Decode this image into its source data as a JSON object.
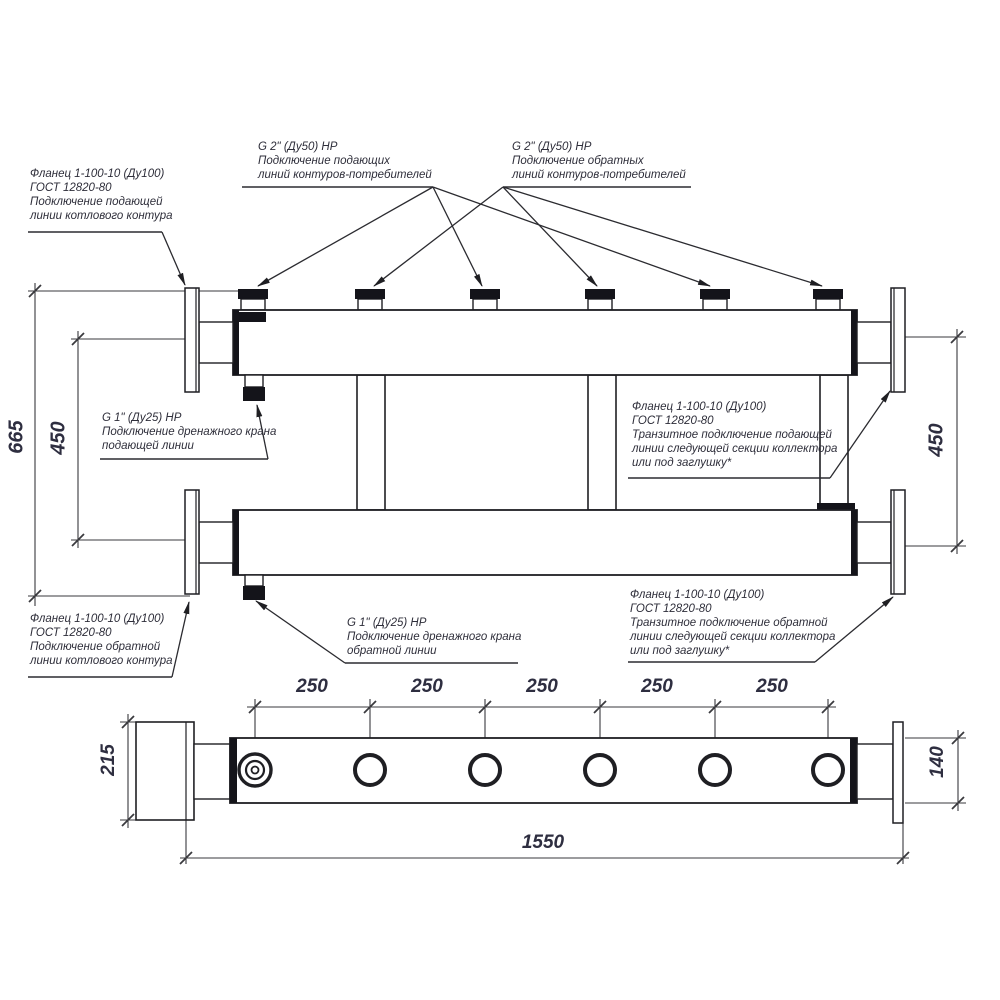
{
  "labels": {
    "flange_supply_boiler": "Фланец 1-100-10 (Ду100)\nГОСТ 12820-80\nПодключение подающей\nлинии котлового контура",
    "supply_consumers": "G 2\" (Ду50) НР\nПодключение подающих\nлиний контуров-потребителей",
    "return_consumers": "G 2\" (Ду50) НР\nПодключение обратных\nлиний контуров-потребителей",
    "drain_supply": "G 1\" (Ду25) НР\nПодключение дренажного крана\nподающей линии",
    "flange_transit_supply": "Фланец 1-100-10 (Ду100)\nГОСТ 12820-80\nТранзитное подключение подающей\nлинии следующей секции коллектора\nили под заглушку*",
    "flange_return_boiler": "Фланец 1-100-10 (Ду100)\nГОСТ 12820-80\nПодключение обратной\nлинии котлового контура",
    "drain_return": "G 1\" (Ду25) НР\nПодключение дренажного крана\nобратной линии",
    "flange_transit_return": "Фланец 1-100-10 (Ду100)\nГОСТ 12820-80\nТранзитное подключение обратной\nлинии следующей секции коллектора\nили под заглушку*"
  },
  "dimensions": {
    "overall_height": "665",
    "axis_distance_left": "450",
    "axis_distance_right": "450",
    "nozzle_spacing": [
      "250",
      "250",
      "250",
      "250",
      "250"
    ],
    "overall_length": "1550",
    "flange_height": "215",
    "body_diameter": "140"
  },
  "colors": {
    "background": "#ffffff",
    "outline": "#1f1f23",
    "thin_line": "#3a3a3e",
    "text": "#2e2e3a"
  }
}
